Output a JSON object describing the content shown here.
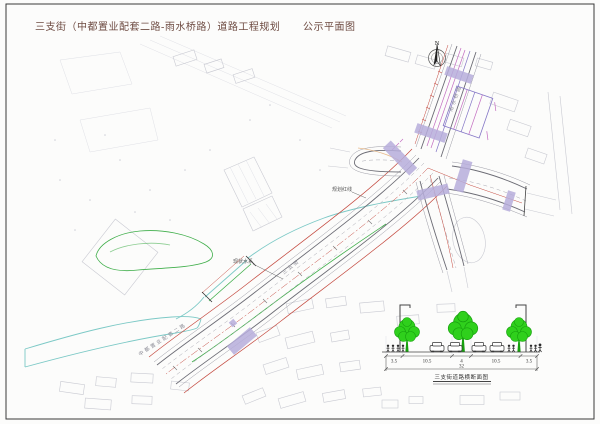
{
  "header": {
    "title_main": "三支街（中都置业配套二路-雨水桥路）道路工程规划",
    "title_sub": "公示平面图"
  },
  "compass": {
    "north_label": "N"
  },
  "plan": {
    "main_road_name": "三支街",
    "north_road_name": "雨水桥路",
    "end_road_name": "中都置业配套二路",
    "label_water": "现状水系",
    "label_redline": "规划红线"
  },
  "cross_section": {
    "dims": [
      "3.5",
      "10.5",
      "4",
      "10.5",
      "3.5"
    ],
    "total": "32",
    "caption": "三支街道路横断面图"
  },
  "colors": {
    "title": "#6d4a41",
    "frame": "#3a3a3a",
    "faint": "#c9cad2",
    "faint2": "#dfe0e6",
    "edge": "#6b6b74",
    "red": "#c4493f",
    "cw": "#b6addb",
    "magenta": "#c36cc1",
    "purple": "#8476c6",
    "water": "#7cc9c6",
    "green": "#3fae4a",
    "tree": "#2fd01c",
    "treedark": "#17a00e",
    "orange": "#e3a769"
  }
}
